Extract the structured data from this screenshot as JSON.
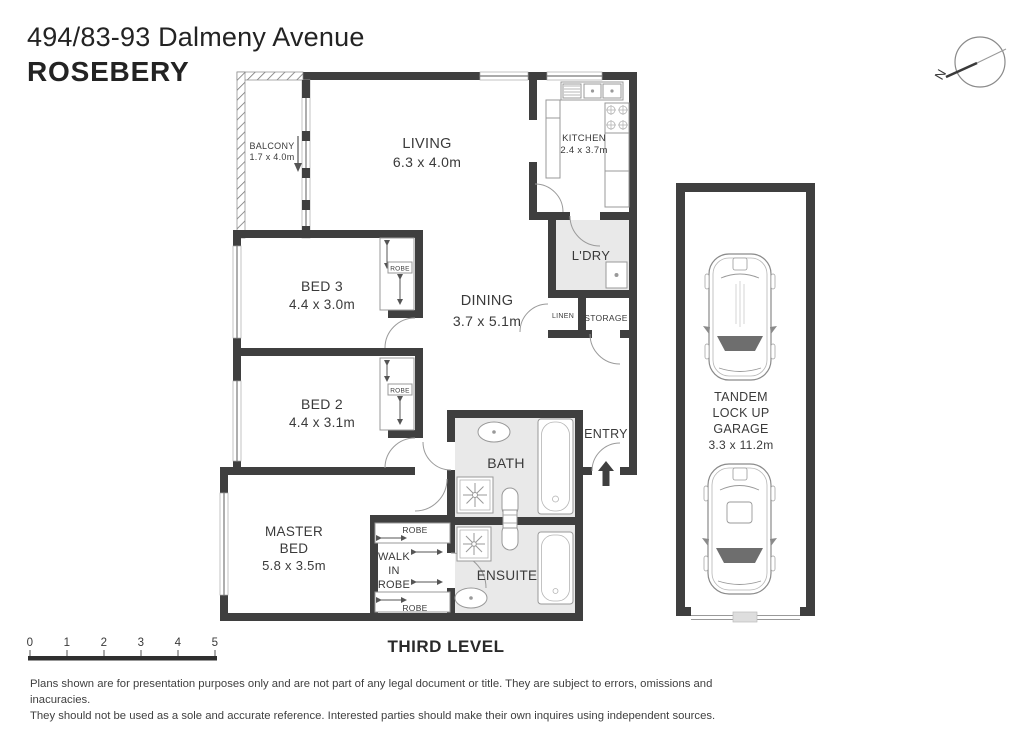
{
  "header": {
    "address": "494/83-93 Dalmeny Avenue",
    "suburb": "ROSEBERY"
  },
  "compass": {
    "north": "N"
  },
  "plan": {
    "balcony_name": "BALCONY",
    "balcony_dims": "1.7 x 4.0m",
    "living_name": "LIVING",
    "living_dims": "6.3 x 4.0m",
    "kitchen_name": "KITCHEN",
    "kitchen_dims": "2.4 x 3.7m",
    "laundry_name": "L'DRY",
    "dining_name": "DINING",
    "dining_dims": "3.7 x 5.1m",
    "linen_name": "LINEN",
    "storage_name": "STORAGE",
    "bed3_name": "BED 3",
    "bed3_dims": "4.4 x 3.0m",
    "bed2_name": "BED 2",
    "bed2_dims": "4.4 x 3.1m",
    "bath_name": "BATH",
    "entry_name": "ENTRY",
    "master_name1": "MASTER",
    "master_name2": "BED",
    "master_dims": "5.8 x 3.5m",
    "wir_line1": "WALK",
    "wir_line2": "IN",
    "wir_line3": "ROBE",
    "robe_label": "ROBE",
    "ensuite_name": "ENSUITE"
  },
  "garage": {
    "line1": "TANDEM",
    "line2": "LOCK UP",
    "line3": "GARAGE",
    "dims": "3.3 x 11.2m"
  },
  "scale_bar": {
    "ticks": [
      "0",
      "1",
      "2",
      "3",
      "4",
      "5"
    ]
  },
  "level_label": "THIRD LEVEL",
  "disclaimer": {
    "line1": "Plans shown are for presentation purposes only and are not part of any legal document or title. They are subject to errors, omissions and inacuracies.",
    "line2": "They should not be used as a sole and accurate reference. Interested parties should make their own inquires using independent sources."
  },
  "colors": {
    "wall": "#3f3f3f",
    "wet_area": "#e9e9e9",
    "text": "#3a3a3a"
  }
}
